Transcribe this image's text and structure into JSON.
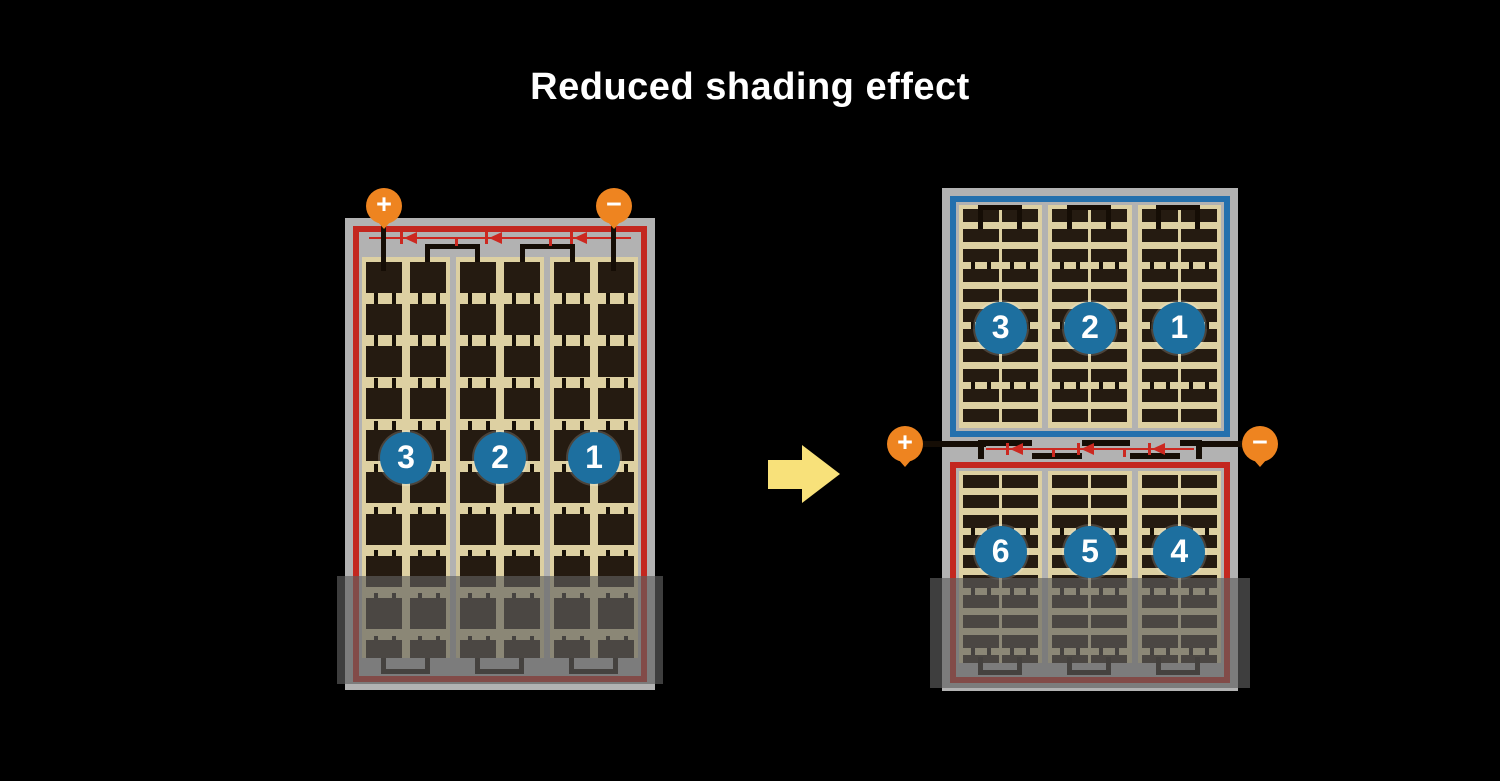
{
  "title": "Reduced shading effect",
  "left_panel": {
    "terminals": {
      "positive": "+",
      "negative": "−"
    },
    "strings": [
      {
        "label": "3"
      },
      {
        "label": "2"
      },
      {
        "label": "1"
      }
    ]
  },
  "right_panel": {
    "terminals": {
      "positive": "+",
      "negative": "−"
    },
    "top_strings": [
      {
        "label": "3"
      },
      {
        "label": "2"
      },
      {
        "label": "1"
      }
    ],
    "bottom_strings": [
      {
        "label": "6"
      },
      {
        "label": "5"
      },
      {
        "label": "4"
      }
    ]
  },
  "colors": {
    "bg": "#000000",
    "text": "#ffffff",
    "frame": "#b2b2b2",
    "tan": "#ddd0a2",
    "cell": "#251b11",
    "red": "#c3271f",
    "blue": "#2470ad",
    "circle": "#1d6f9f",
    "orange": "#ee8420",
    "diode": "#cc2820",
    "bus": "#150d05",
    "arrow": "#f8e17a",
    "shade": "rgba(95,95,95,0.65)"
  }
}
